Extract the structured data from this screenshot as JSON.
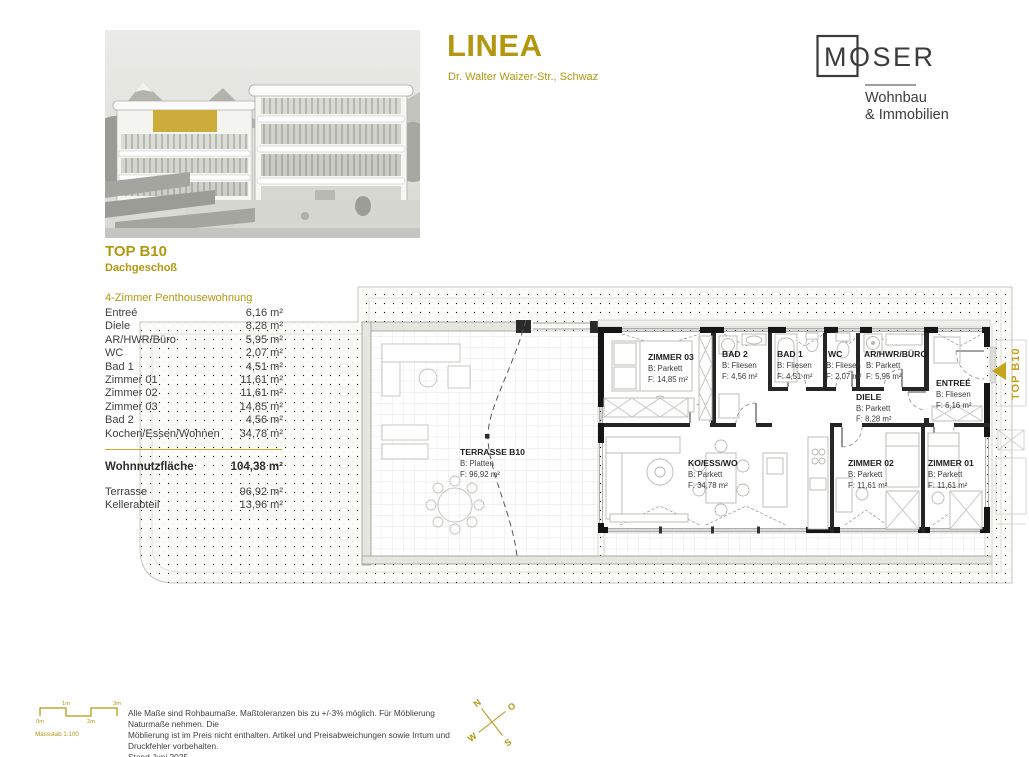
{
  "header": {
    "project": {
      "title": "LINEA",
      "subtitle": "Dr. Walter Waizer-Str., Schwaz"
    },
    "brand": {
      "name": "MOSER",
      "line1": "Wohnbau",
      "line2": "& Immobilien"
    }
  },
  "unit": {
    "code": "TOP B10",
    "floor": "Dachgeschoß",
    "type": "4-Zimmer Penthousewohnung"
  },
  "room_table": {
    "rows": [
      {
        "label": "Entreé",
        "value": "6,16 m²"
      },
      {
        "label": "Diele",
        "value": "8,28 m²"
      },
      {
        "label": "AR/HWR/Büro",
        "value": "5,95 m²"
      },
      {
        "label": "WC",
        "value": "2,07 m²"
      },
      {
        "label": "Bad 1",
        "value": "4,51 m²"
      },
      {
        "label": "Zimmer 01",
        "value": "11,61 m²"
      },
      {
        "label": "Zimmer 02",
        "value": "11,61 m²"
      },
      {
        "label": "Zimmer 03",
        "value": "14,85 m²"
      },
      {
        "label": "Bad 2",
        "value": "4,56 m²"
      },
      {
        "label": "Kochen/Essen/Wohnen",
        "value": "34,78 m²"
      }
    ],
    "total": {
      "label": "Wohnnutzfläche",
      "value": "104,38 m²"
    },
    "extras": [
      {
        "label": "Terrasse",
        "value": "96,92 m²"
      },
      {
        "label": "Kellerabteil",
        "value": "13,96 m²"
      }
    ]
  },
  "plan": {
    "rooms": [
      {
        "name": "ZIMMER 03",
        "floor": "B: Parkett",
        "area": "F: 14,85 m²"
      },
      {
        "name": "BAD 2",
        "floor": "B: Fliesen",
        "area": "F: 4,56 m²"
      },
      {
        "name": "BAD 1",
        "floor": "B: Fliesen",
        "area": "F: 4,51 m²"
      },
      {
        "name": "WC",
        "floor": "B: Fliesen",
        "area": "F: 2,07 m²"
      },
      {
        "name": "AR/HWR/BÜRO",
        "floor": "B: Parkett",
        "area": "F: 5,95 m²"
      },
      {
        "name": "ENTREÉ",
        "floor": "B: Fliesen",
        "area": "F: 6,16 m²"
      },
      {
        "name": "DIELE",
        "floor": "B: Parkett",
        "area": "F: 8,28 m²"
      },
      {
        "name": "KO/ESS/WO",
        "floor": "B: Parkett",
        "area": "F: 34,78 m²"
      },
      {
        "name": "ZIMMER 02",
        "floor": "B: Parkett",
        "area": "F: 11,61 m²"
      },
      {
        "name": "ZIMMER 01",
        "floor": "B: Parkett",
        "area": "F: 11,61 m²"
      },
      {
        "name": "TERRASSE B10",
        "floor": "B: Platten",
        "area": "F: 96,92 m²"
      }
    ],
    "unit_marker": "TOP B10"
  },
  "footer": {
    "scale": {
      "label": "Massstab 1:100",
      "ticks": [
        "0m",
        "1m",
        "2m",
        "3m"
      ]
    },
    "disclaimer": {
      "line1": "Alle Maße sind Rohbaumaße. Maßtoleranzen bis zu +/-3% möglich. Für Möblierung Naturmaße nehmen. Die",
      "line2": "Möblierung ist im Preis nicht enthalten. Artikel und Preisabweichungen sowie Irrtum und Druckfehler vorbehalten.",
      "line3": "Stand Juni 2025"
    },
    "compass": {
      "n": "N",
      "o": "O",
      "s": "S",
      "w": "W"
    }
  },
  "colors": {
    "gold": "#b2970f",
    "ink": "#3b3b3b"
  }
}
